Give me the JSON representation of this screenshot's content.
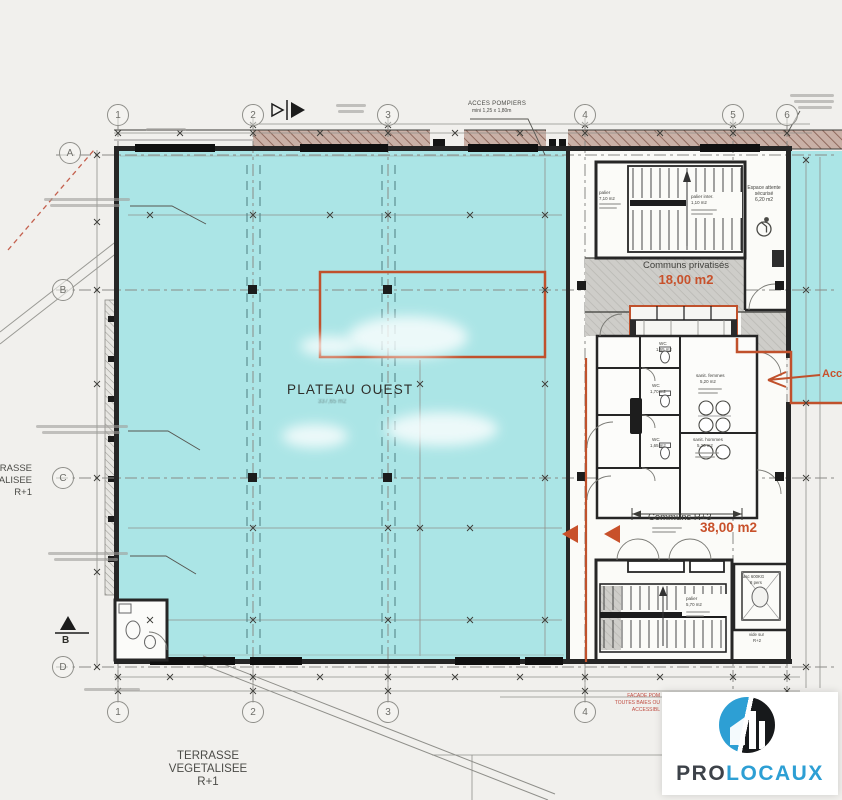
{
  "colors": {
    "plateau_cyan": "#abe5e6",
    "annotation_orange": "#c8512b",
    "commons_grey": "#cecdc9",
    "facade_hatch": "#c9b0a6",
    "note_red": "#bf4b40",
    "logo_blue": "#2d9fd4",
    "logo_dark": "#17191b"
  },
  "grid": {
    "top": [
      "1",
      "2",
      "3",
      "4",
      "5",
      "6"
    ],
    "bottom": [
      "1",
      "2",
      "3",
      "4"
    ],
    "left": [
      "A",
      "B",
      "C",
      "D"
    ],
    "section_marker": "B"
  },
  "rooms": {
    "plateau_ouest": {
      "name": "PLATEAU OUEST",
      "area": "337,65 m2"
    },
    "palier_top": {
      "name": "palier",
      "area": "7,10 m2"
    },
    "palier_inter": {
      "name": "palier inter.",
      "area": "1,10 m2"
    },
    "espace_attente": {
      "line1": "Espace attente",
      "line2": "sécurisé",
      "area": "6,20 m2"
    },
    "communs_privatises": {
      "name": "Communs privatisés",
      "area": "18,00 m2"
    },
    "wc1": {
      "name": "WC",
      "area": "1,65 m2"
    },
    "wc2": {
      "name": "WC",
      "area": "1,70 m2"
    },
    "wc3": {
      "name": "WC",
      "area": "1,65 m2"
    },
    "sanit_femmes": {
      "name": "sanit. femmes",
      "area": "5,20 m2"
    },
    "sanit_hommes": {
      "name": "sanit. hommes",
      "area": "5,20 m2"
    },
    "communs_r3": {
      "name": "Communs R+3",
      "area": "38,00 m2"
    },
    "palier_bas": {
      "name": "palier",
      "area": "5,70 m2"
    },
    "ascenseur": {
      "line1": "asc 600KG",
      "line2": "8 pers"
    },
    "vide_sur": {
      "line1": "vide sur",
      "line2": "R+2"
    }
  },
  "terrasse": {
    "line1": "TERRASSE",
    "line2": "VEGETALISEE",
    "line3": "R+1"
  },
  "notes": {
    "acces_pompiers": "ACCES POMPIERS",
    "acces_pompiers_dim": "mini 1,25 x 1,80m",
    "acces_est": "Acc",
    "facade1": "FACADE POM",
    "facade2": "TOUTES BAIES OU",
    "facade3": "ACCESSIBL"
  },
  "logo": {
    "pro": "PRO",
    "locaux": "LOCAUX"
  }
}
